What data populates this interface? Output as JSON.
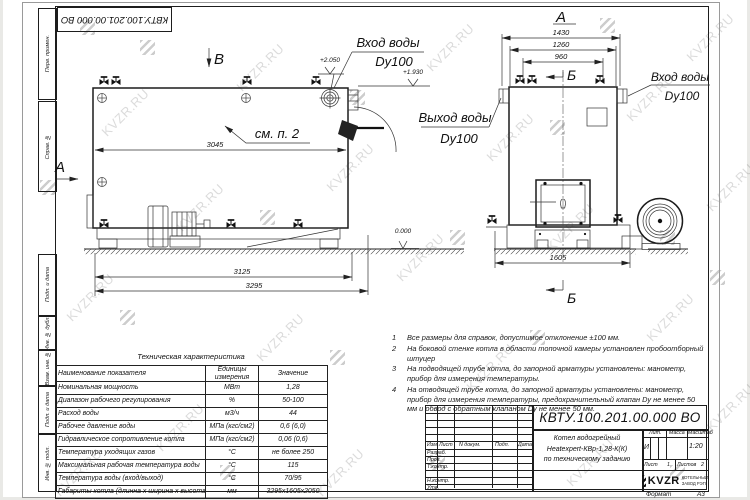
{
  "sheet": {
    "stamp_top_left": "КВТУ.100.201.00.000 ВО",
    "watermark_text": "KVZR.RU",
    "format_label": "Формат",
    "format_value": "А3"
  },
  "margin_labels": [
    "Перв. примен.",
    "Справ. №",
    "Подп. и дата",
    "Инв. № дубл.",
    "Взам. инв. №",
    "Подп. и дата",
    "Инв. № подл."
  ],
  "drawing": {
    "view_a_marker": "А",
    "view_b_marker": "В",
    "view_a_label": "А",
    "section_b_top": "Б",
    "section_b_bottom": "Б",
    "dims": {
      "length_top": "3045",
      "length_mid": "3125",
      "length_total": "3295",
      "width_top": "1430",
      "width_mid": "1260",
      "width_inner": "960",
      "base_width": "1605"
    },
    "levels": {
      "inlet": "+2.050",
      "outlet": "+1.930",
      "zero": "0.000"
    },
    "labels": {
      "inlet_left": "Вход воды",
      "inlet_left_dn": "Dy100",
      "outlet": "Выход воды",
      "outlet_dn": "Dy100",
      "inlet_right": "Вход воды",
      "inlet_right_dn": "Dy100",
      "see_note": "см. п. 2"
    }
  },
  "notes": {
    "items": [
      {
        "num": "1",
        "text": "Все размеры для справок, допустимое отклонение ±100 мм."
      },
      {
        "num": "2",
        "text": "На боковой стенке котла в области топочной камеры установлен пробоотборный штуцер"
      },
      {
        "num": "3",
        "text": "На  подводящей трубе котла, до запорной арматуры установлены: манометр, прибор для измерения температуры."
      },
      {
        "num": "4",
        "text": "На отводящей трубе котла, до запорной арматуры установлены: манометр, прибор для измерения температуры, предохранительный клапан Dу не менее 50 мм и обвод с обратным клапаном Dу не менее 50 мм."
      }
    ]
  },
  "tech_table": {
    "title": "Техническая характеристика",
    "headers": {
      "name": "Наименование показателя",
      "units": "Единицы измерения",
      "value": "Значение"
    },
    "rows": [
      {
        "name": "Номинальная мощность",
        "units": "МВт",
        "value": "1,28"
      },
      {
        "name": "Диапазон рабочего регулирования",
        "units": "%",
        "value": "50-100"
      },
      {
        "name": "Расход воды",
        "units": "м3/ч",
        "value": "44"
      },
      {
        "name": "Рабочее давление воды",
        "units": "МПа (кгс/см2)",
        "value": "0,6 (6,0)"
      },
      {
        "name": "Гидравлическое сопротивление котла",
        "units": "МПа (кгс/см2)",
        "value": "0,06 (0,6)"
      },
      {
        "name": "Температура уходящих газов",
        "units": "°С",
        "value": "не более 250"
      },
      {
        "name": "Максимальная рабочая температура воды",
        "units": "°С",
        "value": "115"
      },
      {
        "name": "Температура воды (вход/выход)",
        "units": "°С",
        "value": "70/95"
      },
      {
        "name": "Габариты котла (длинна х ширина х высота)",
        "units": "мм",
        "value": "3295х1605х2050"
      }
    ]
  },
  "title_block": {
    "doc_number": "КВТУ.100.201.00.000 ВО",
    "rev_cols": {
      "izm": "Изм",
      "list": "Лист",
      "ndoc": "N докум.",
      "podp": "Подп.",
      "date": "Дата"
    },
    "roles": {
      "developed": "Разраб.",
      "checked": "Пров.",
      "tcontrol": "Т.контр.",
      "ncontrol": "Н.контр.",
      "approved": "Утв."
    },
    "name_line1": "Котел водогрейный",
    "name_line2": "Heatexpert-КВр-1,28-К(К)",
    "name_line3": "по техническому заданию",
    "lit_header": "Лит.",
    "lit_value": "И",
    "mass_header": "Масса",
    "scale_header": "Масштаб",
    "scale_value": "1:20",
    "sheet_label": "Лист",
    "sheet_num": "1",
    "sheets_label": "Листов",
    "sheets_num": "2",
    "logo_text": "KVZR",
    "logo_caption1": "КОТЕЛЬНЫЙ",
    "logo_caption2": "ЗАВОД РЭП"
  }
}
